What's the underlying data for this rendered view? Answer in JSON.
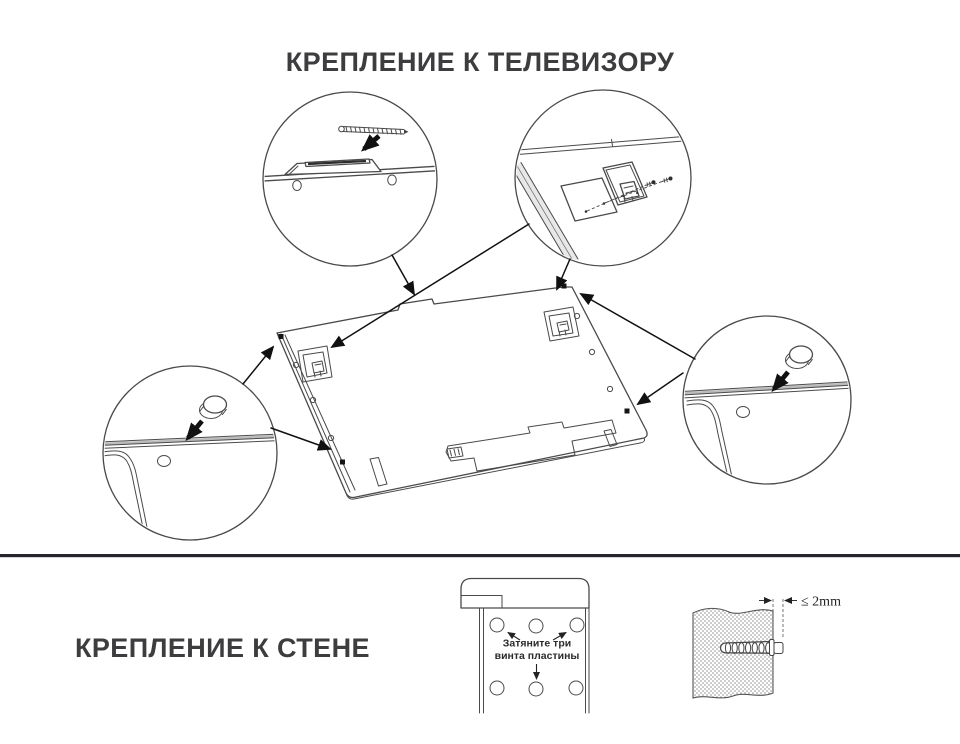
{
  "header": {
    "title": "КРЕПЛЕНИЕ К ТЕЛЕВИЗОРУ"
  },
  "wall_section": {
    "title": "КРЕПЛЕНИЕ К СТЕНЕ",
    "plate_note_line1": "Затяните три",
    "plate_note_line2": "винта пластины",
    "anchor_gap_label": "≤ 2mm"
  },
  "colors": {
    "background": "#ffffff",
    "title_text": "#3d3d3f",
    "line_art": "#4a4a4a",
    "arrow_ink": "#111111",
    "divider": "#26262a",
    "wall_stipple": "#8f8f8f"
  }
}
